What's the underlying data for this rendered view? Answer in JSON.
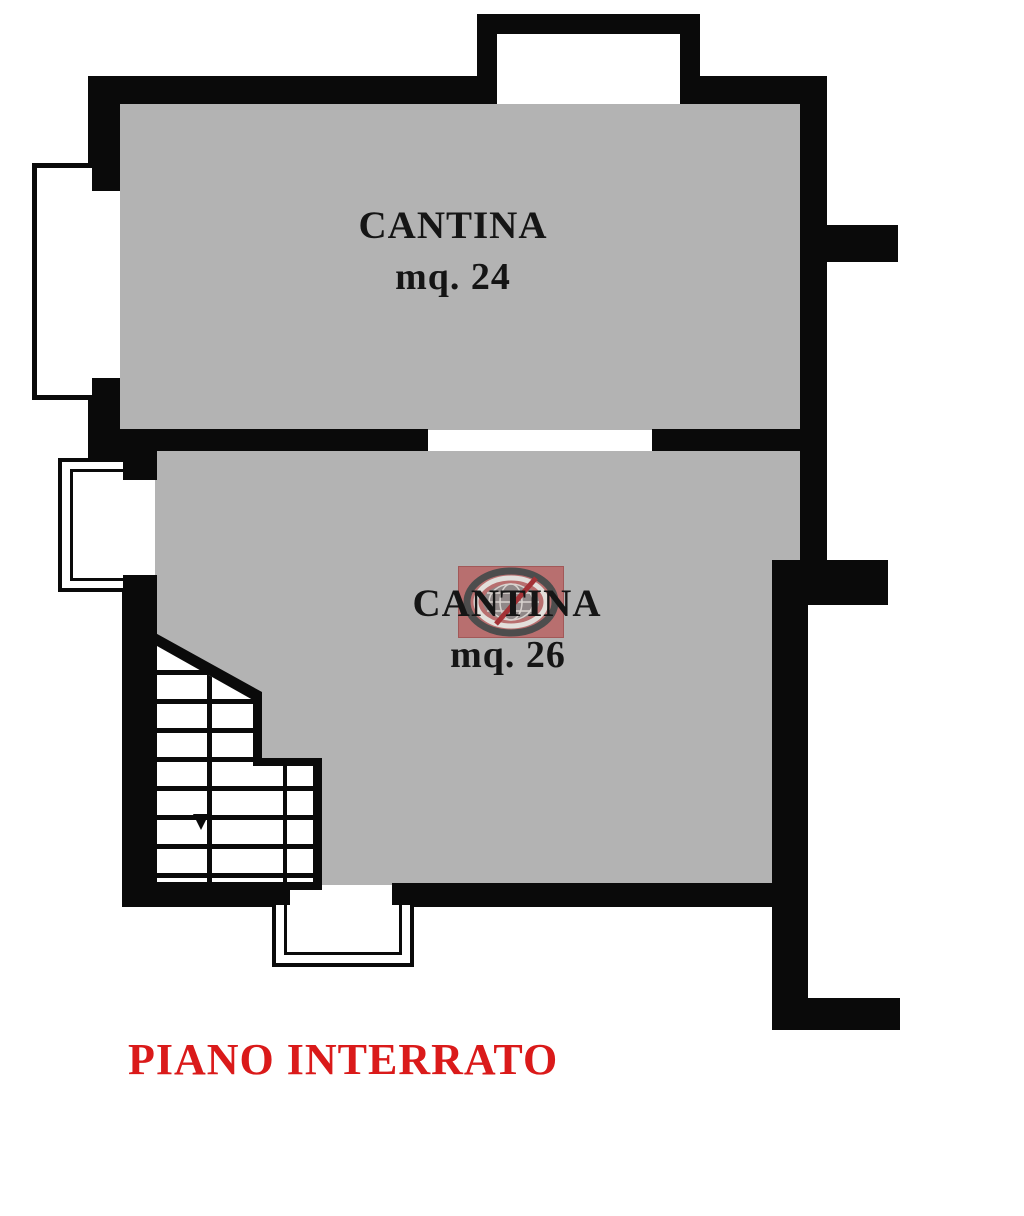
{
  "plan": {
    "floor_title": "PIANO INTERRATO",
    "rooms": [
      {
        "label": "CANTINA",
        "area": "mq. 24"
      },
      {
        "label": "CANTINA",
        "area": "mq. 26"
      }
    ]
  },
  "watermark": {
    "name": "globe-logo-watermark"
  },
  "colors": {
    "background": "#ffffff",
    "wall": "#0a0a0a",
    "room_fill": "#b3b3b3",
    "title_red": "#da1a1a",
    "watermark_square": "#b96a6a",
    "watermark_ring_dark": "#454545",
    "watermark_ring_light": "#e6e3df",
    "watermark_globe": "#8e8585",
    "watermark_slash": "#a3282c"
  }
}
